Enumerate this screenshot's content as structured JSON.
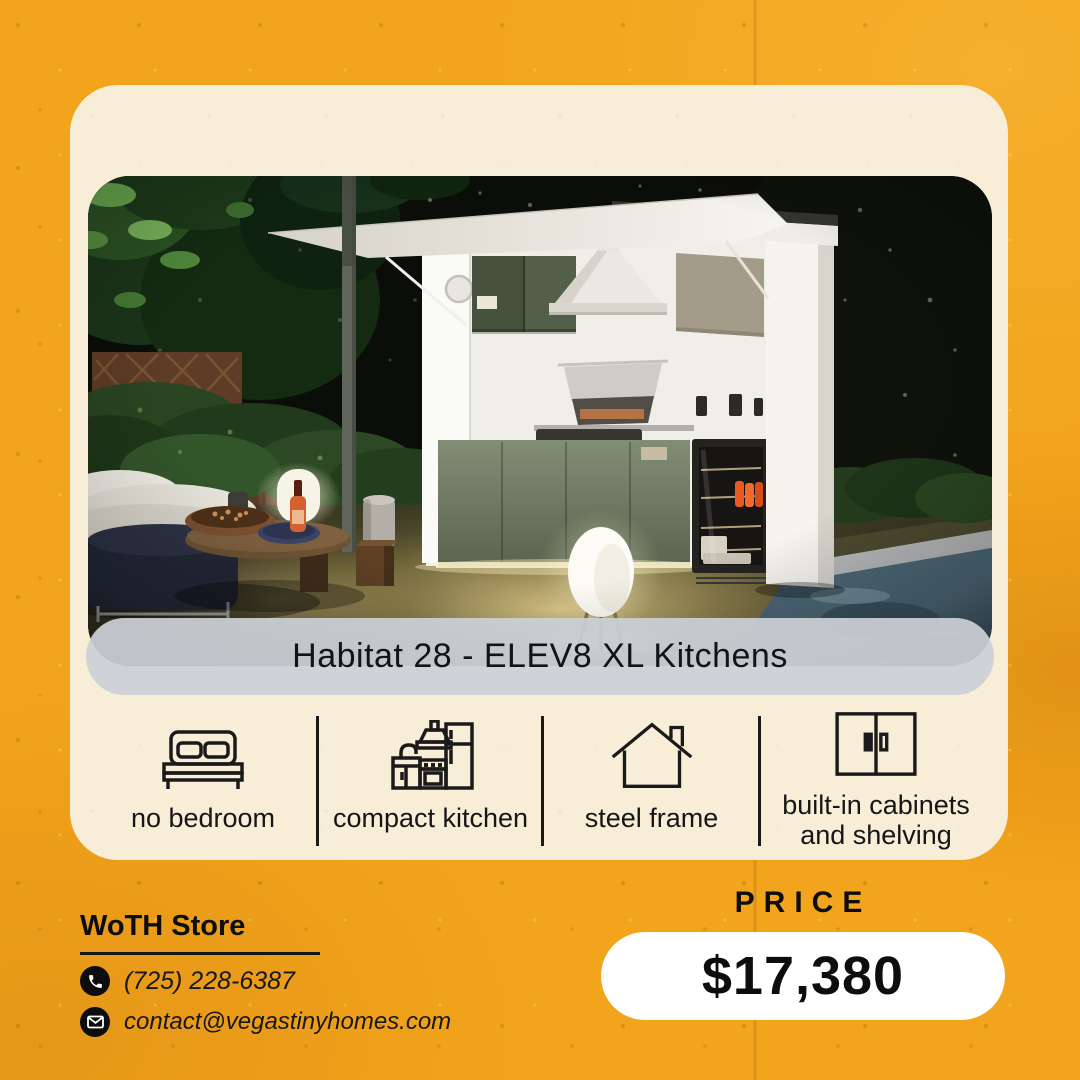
{
  "colors": {
    "background": "#F2A41C",
    "card": "#F8EED8",
    "text": "#0D0D0D",
    "photo_pill": "#CBD0D5",
    "price_pill": "#FFFFFF",
    "divider": "#1A1A1A"
  },
  "header": {
    "title": "WoTH STORE"
  },
  "product": {
    "name": "Habitat 28 - ELEV8 XL Kitchens"
  },
  "features": [
    {
      "icon": "bed-icon",
      "label": "no bedroom"
    },
    {
      "icon": "kitchen-icon",
      "label": "compact kitchen"
    },
    {
      "icon": "house-icon",
      "label": "steel frame"
    },
    {
      "icon": "cabinet-icon",
      "label": "built-in cabinets and shelving"
    }
  ],
  "contact": {
    "store_name": "WoTH Store",
    "phone_icon": "phone-icon",
    "phone": "(725) 228-6387",
    "email_icon": "email-icon",
    "email": "contact@vegastinyhomes.com"
  },
  "price": {
    "label": "PRICE",
    "value": "$17,380"
  }
}
